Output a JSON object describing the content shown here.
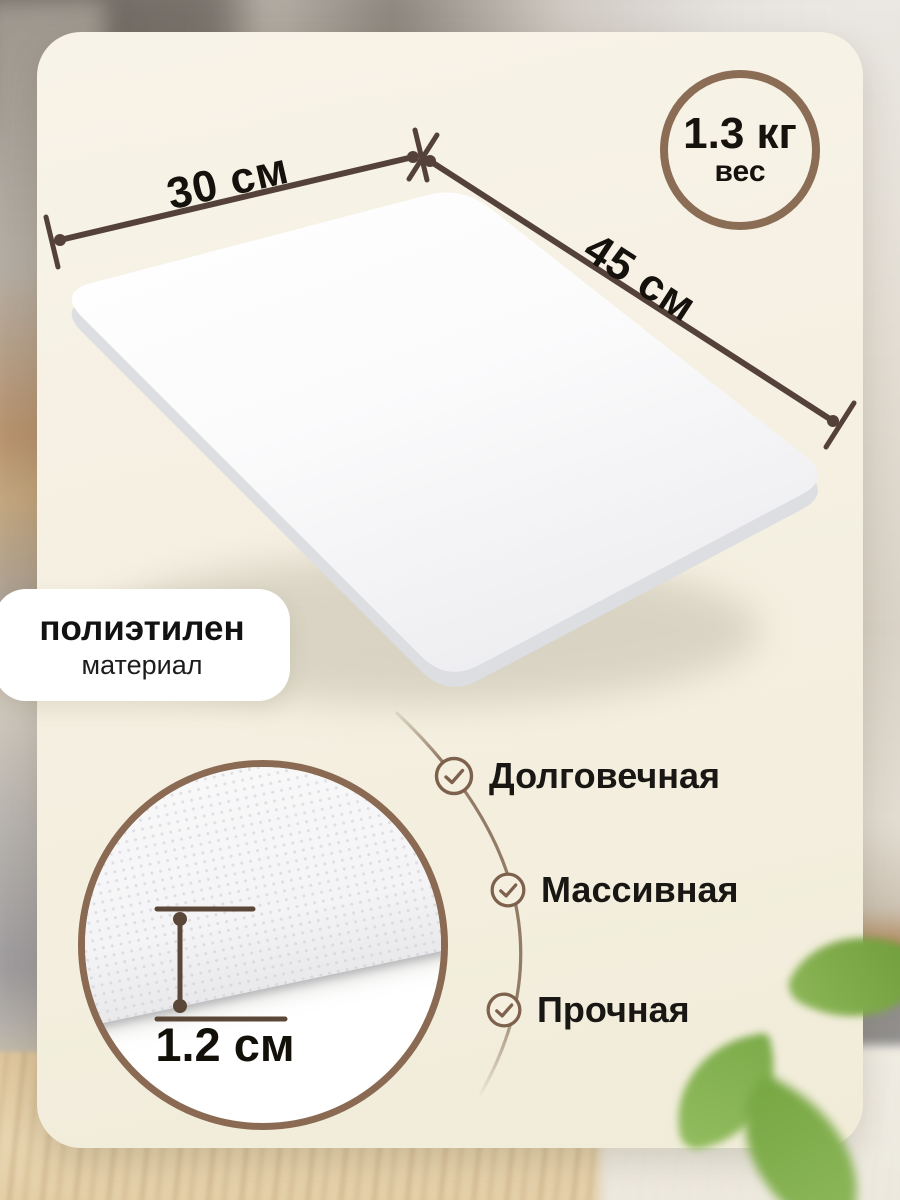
{
  "product": {
    "type": "cutting-board-product-photo",
    "dimensions": {
      "width": "30 см",
      "length": "45 см",
      "thickness": "1.2 см"
    },
    "weight": {
      "value": "1.3 кг",
      "label": "вес"
    },
    "material": {
      "value": "полиэтилен",
      "label": "материал"
    },
    "features": [
      "Долговечная",
      "Массивная",
      "Прочная"
    ],
    "icons": {
      "feature": "check-circle-icon"
    },
    "colors": {
      "accent_brown": "#8b6d55",
      "dimension_line": "#54423a",
      "connector_arc": "#937c66",
      "card_background": "#f5f0e2",
      "text": "#15110d",
      "leaf_green": "#7cab49"
    }
  }
}
